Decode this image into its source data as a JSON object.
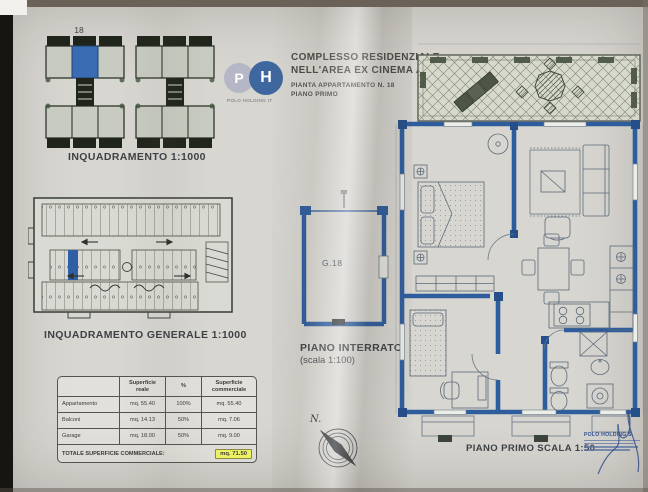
{
  "document": {
    "header": {
      "logo": {
        "letter_p": "P",
        "letter_h": "H",
        "caption": "POLO HOLDING.IT"
      },
      "title_line1": "COMPLESSO RESIDENZIALE",
      "title_line2": "NELL'AREA EX CINEMA A MAROTTA",
      "subtitle_line1": "PIANTA APPARTAMENTO N. 18",
      "subtitle_line2": "PIANO PRIMO"
    },
    "site_plan": {
      "building_label": "18",
      "caption": "INQUADRAMENTO 1:1000"
    },
    "garage_plan": {
      "caption": "INQUADRAMENTO GENERALE 1:1000"
    },
    "basement": {
      "unit_label": "G.18",
      "section_mark": "8 8",
      "caption_line1": "PIANO INTERRATO",
      "caption_line2": "(scala 1:100)"
    },
    "first_floor": {
      "caption": "PIANO PRIMO SCALA 1:50"
    },
    "compass_label": "N.",
    "areas_table": {
      "headers": {
        "col1": "Superficie reale",
        "col2": "%",
        "col3": "Superficie commerciale"
      },
      "rows": [
        {
          "label": "Appartamento",
          "reale": "mq. 55.40",
          "pct": "100%",
          "comm": "mq. 55.40"
        },
        {
          "label": "Balconi",
          "reale": "mq. 14.13",
          "pct": "50%",
          "comm": "mq. 7.06"
        },
        {
          "label": "Garage",
          "reale": "mq. 18.00",
          "pct": "50%",
          "comm": "mq. 9.00"
        }
      ],
      "total_label": "TOTALE SUPERFICIE COMMERCIALE:",
      "total_value": "mq. 71.50"
    },
    "stamp": {
      "company": "POLO HOLDING S."
    }
  },
  "colors": {
    "wall_blue": "#2e5d9e",
    "unit_blue": "#3a6cb4",
    "highlight_yellow": "#ecf263",
    "paper": "#d8d6d1",
    "logo_p": "#b6b7c6",
    "logo_h": "#3f679f",
    "stamp_blue": "#31508f"
  }
}
